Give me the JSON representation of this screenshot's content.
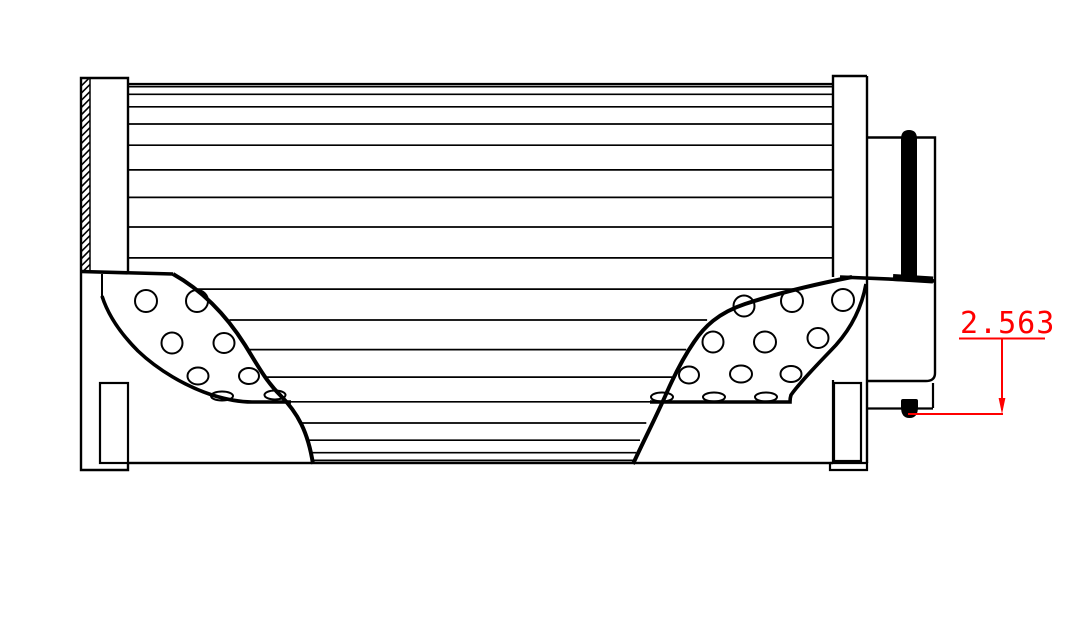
{
  "drawing": {
    "type": "filter-element-cross-section",
    "dimension": {
      "value": "2.563"
    }
  },
  "colors": {
    "line": "#000000",
    "dimension_accent": "#ff0000",
    "background": "#ffffff"
  }
}
